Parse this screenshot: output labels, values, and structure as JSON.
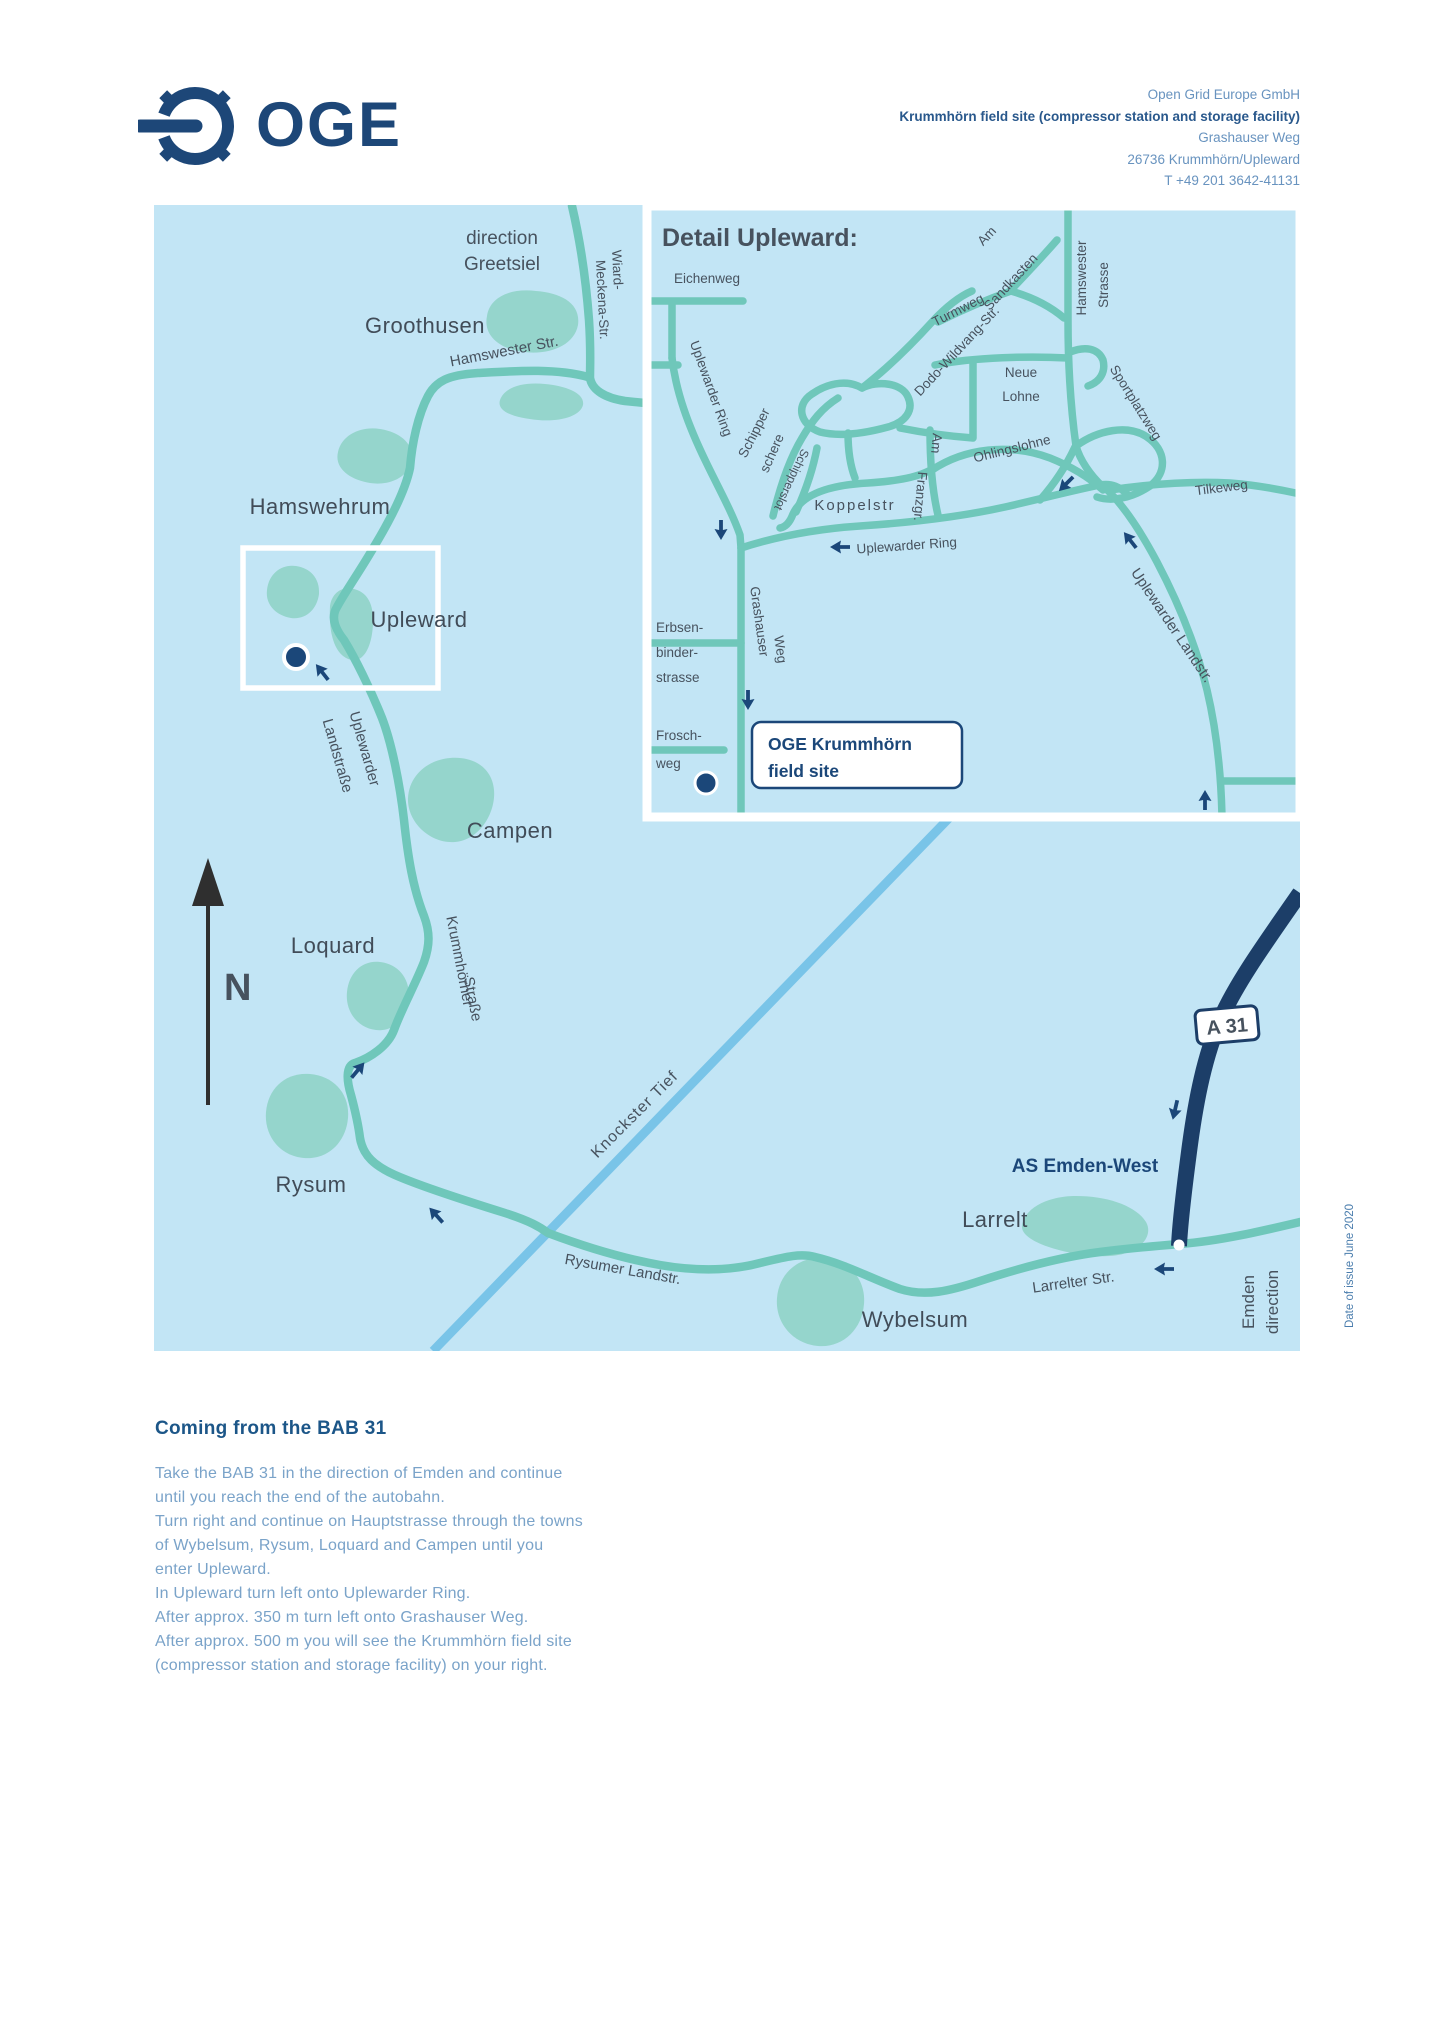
{
  "header": {
    "logo": "OGE",
    "address": {
      "company": "Open Grid Europe GmbH",
      "site": "Krummhörn field site (compressor station and storage facility)",
      "street": "Grashauser Weg",
      "city": "26736 Krummhörn/Upleward",
      "phone": "T +49 201 3642-41131"
    }
  },
  "map": {
    "north_label": "N",
    "towns": {
      "groothusen": "Groothusen",
      "hamswehrum": "Hamswehrum",
      "upleward": "Upleward",
      "campen": "Campen",
      "loquard": "Loquard",
      "rysum": "Rysum",
      "wybelsum": "Wybelsum",
      "larrelt": "Larrelt"
    },
    "labels": {
      "direction_greetsiel_1": "direction",
      "direction_greetsiel_2": "Greetsiel",
      "wiard_1": "Wiard-",
      "wiard_2": "Meckena-Str.",
      "hamswester_str": "Hamswester Str.",
      "uplewarder_landstrasse_1": "Uplewarder",
      "uplewarder_landstrasse_2": "Landstraße",
      "krummhoerner_1": "Krummhörner",
      "krummhoerner_2": "Straße",
      "rysumer_landstr": "Rysumer Landstr.",
      "knockster_tief": "Knockster Tief",
      "larrelter_str": "Larrelter Str.",
      "as_emden_west": "AS Emden-West",
      "a31_badge": "A 31",
      "direction_emden_1": "direction",
      "direction_emden_2": "Emden"
    }
  },
  "inset": {
    "title": "Detail Upleward:",
    "streets": {
      "eichenweg": "Eichenweg",
      "uplewarder_ring_west": "Uplewarder Ring",
      "schipper_1": "Schipper",
      "schipper_2": "schere",
      "schipperslot": "Schipperslot",
      "koppelstr": "Koppelstr",
      "uplewarder_ring_south": "Uplewarder Ring",
      "grashauser_1": "Grashauser",
      "grashauser_2": "Weg",
      "erbsen_1": "Erbsen-",
      "erbsen_2": "binder-",
      "erbsen_3": "strasse",
      "frosch_1": "Frosch-",
      "frosch_2": "weg",
      "turmweg": "Turmweg",
      "dodo_wildvang": "Dodo-Wildvang-Str.",
      "am_sandkasten_1": "Am",
      "am_sandkasten_2": "Sandkasten",
      "hamswester_1": "Hamswester",
      "hamswester_2": "Strasse",
      "neue_lohne_1": "Neue",
      "neue_lohne_2": "Lohne",
      "sportplatzweg": "Sportplatzweg",
      "ohlingslohne": "Ohlingslohne",
      "am_franzgr_1": "Am",
      "am_franzgr_2": "Franzgr.",
      "tilkeweg": "Tilkeweg",
      "uplewarder_landstr": "Uplewarder Landstr."
    },
    "site_box": {
      "line1": "OGE Krummhörn",
      "line2": "field site"
    }
  },
  "directions": {
    "heading": "Coming from the BAB 31",
    "lines": [
      "Take the BAB 31 in the direction of Emden and continue",
      "until you reach the end of the autobahn.",
      "Turn right and continue on Hauptstrasse through the towns",
      "of Wybelsum, Rysum, Loquard and Campen until you",
      "enter Upleward.",
      "In Upleward turn left onto Uplewarder Ring.",
      "After approx. 350 m turn left onto Grashauser Weg.",
      "After approx. 500 m you will see the Krummhörn field site",
      "(compressor station and storage facility) on your right."
    ]
  },
  "footer": {
    "date_note": "Date of issue June 2020"
  },
  "colors": {
    "navy": "#1b4779",
    "motorway": "#1c3e68",
    "road_teal": "#6fc7ba",
    "map_bg": "#c2e5f5",
    "blob": "#95d5cc",
    "water": "#79c4e8",
    "label_dark": "#414c58",
    "text_light": "#7aa3c9"
  }
}
